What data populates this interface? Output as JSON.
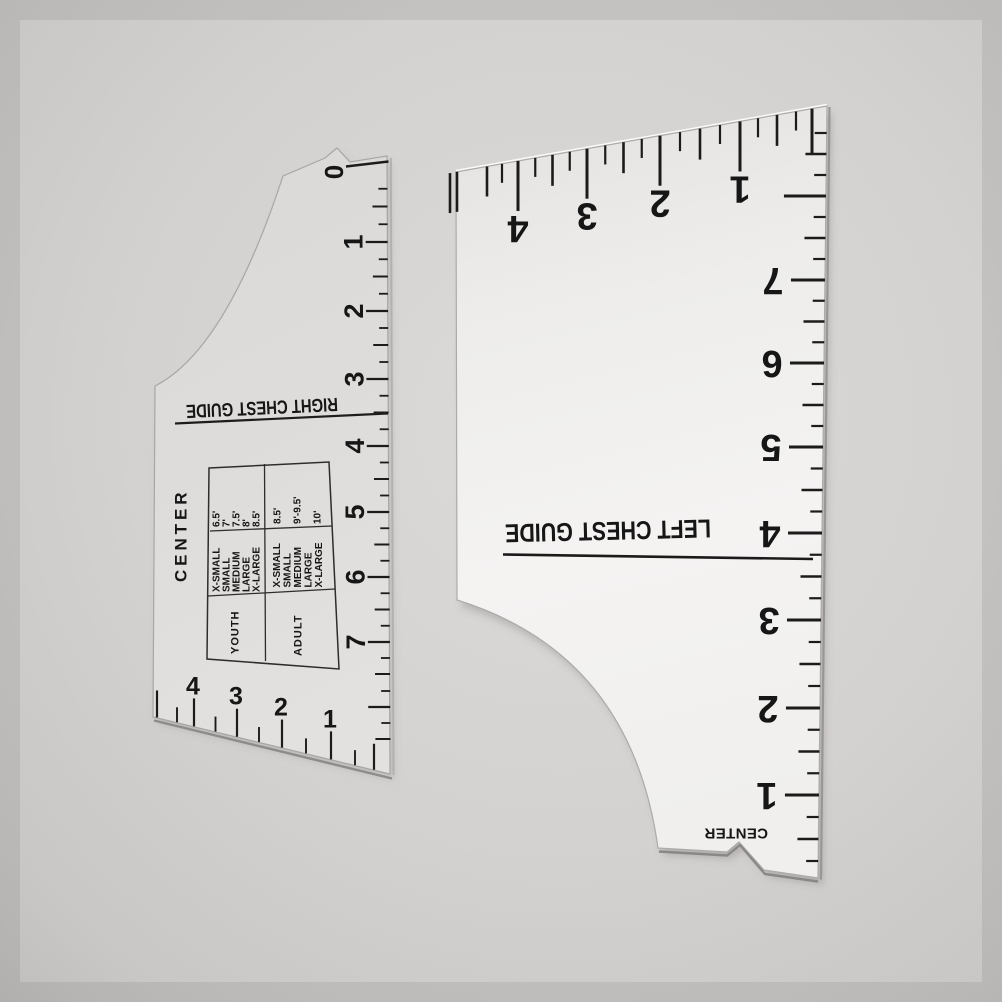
{
  "photo": {
    "background_color": "#d3d1cf",
    "left_ruler": {
      "title": "RIGHT CHEST GUIDE",
      "center_label": "CENTER",
      "side_scale_labels": [
        "0",
        "1",
        "2",
        "3",
        "4",
        "5",
        "6",
        "7"
      ],
      "bottom_scale_labels": [
        "4",
        "3",
        "2",
        "1"
      ],
      "size_chart": {
        "groups": [
          {
            "label": "YOUTH",
            "sizes": [
              "X-SMALL",
              "SMALL",
              "MEDIUM",
              "LARGE",
              "X-LARGE"
            ],
            "values": [
              "6.5'",
              "7'",
              "7.5'",
              "8'",
              "8.5'"
            ]
          },
          {
            "label": "ADULT",
            "sizes": [
              "X-SMALL",
              "SMALL",
              "MEDIUM",
              "LARGE",
              "X-LARGE"
            ],
            "values": [
              "8.5'",
              "9'-9.5'",
              "10'"
            ]
          }
        ]
      }
    },
    "right_ruler": {
      "title": "LEFT CHEST GUIDE",
      "center_label": "CENTER",
      "top_scale_labels": [
        "4",
        "3",
        "2",
        "1"
      ],
      "side_scale_labels": [
        "7",
        "6",
        "5",
        "4",
        "3",
        "2",
        "1"
      ]
    }
  }
}
